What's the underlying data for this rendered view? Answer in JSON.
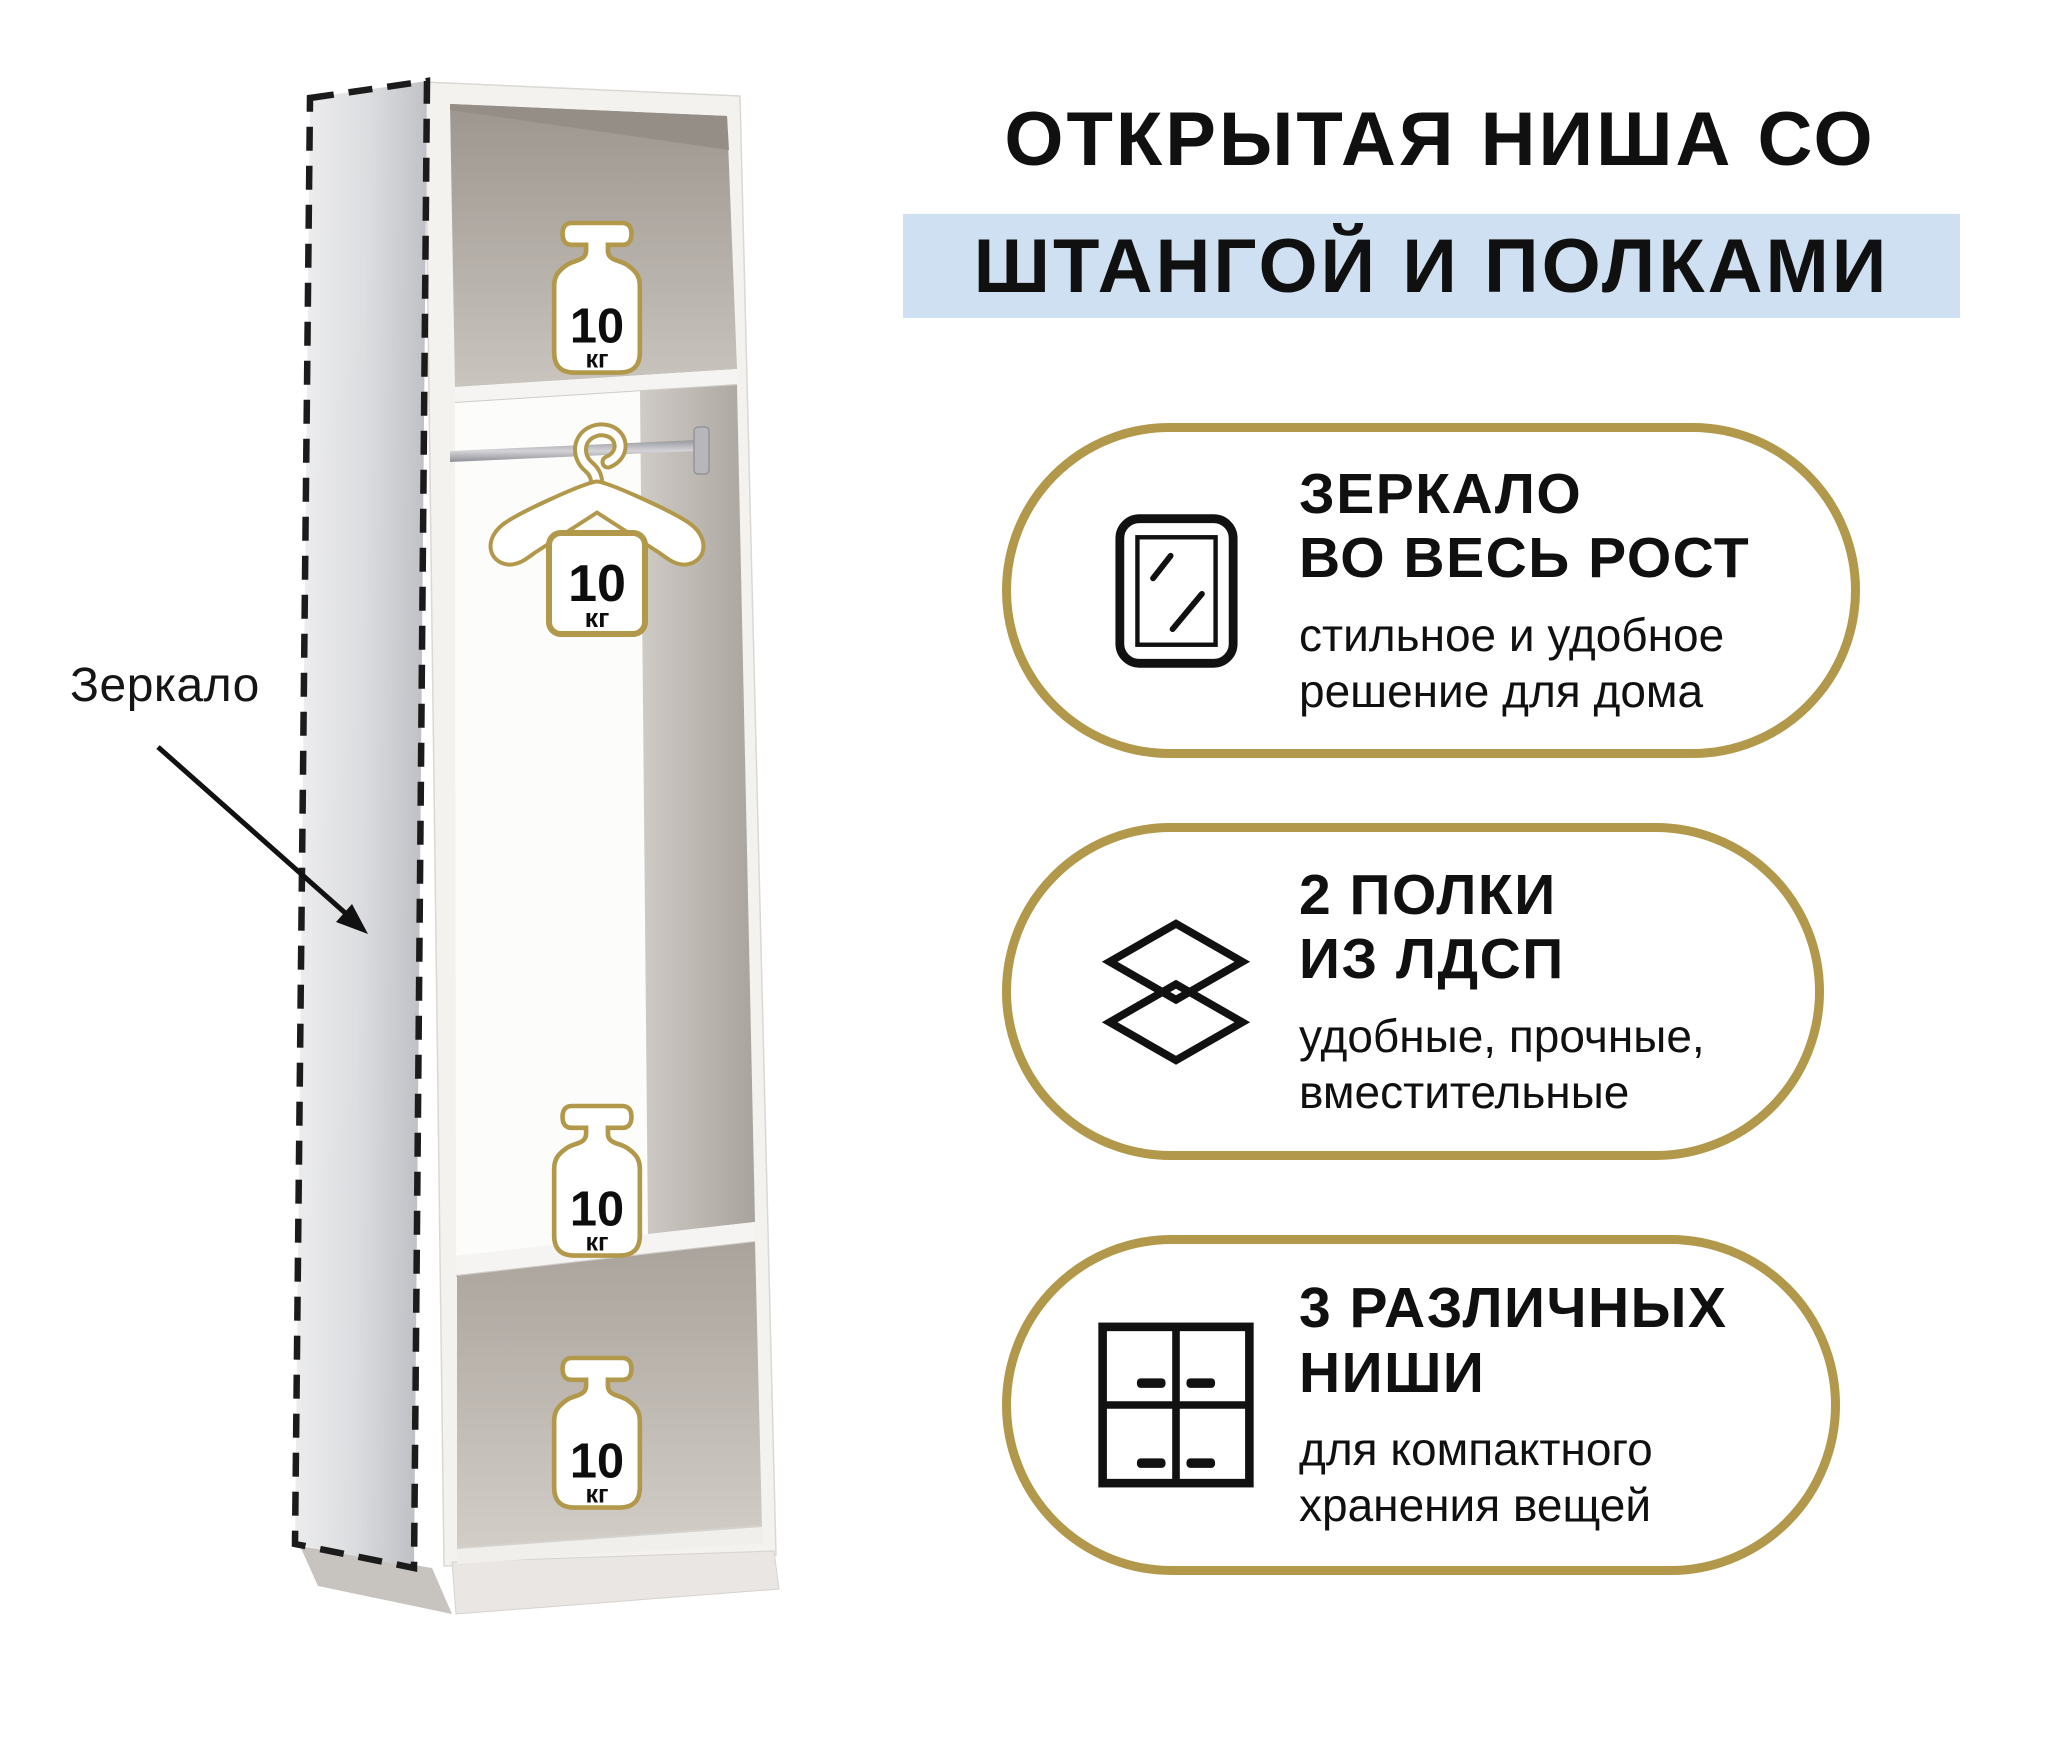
{
  "colors": {
    "accent_gold": "#b2984a",
    "highlight_blue": "#cfe0f3",
    "text": "#101010"
  },
  "title": {
    "line1": "ОТКРЫТАЯ НИША СО",
    "line2": "ШТАНГОЙ И ПОЛКАМИ"
  },
  "diagram": {
    "mirror_label": "Зеркало",
    "weights": [
      {
        "value": "10",
        "unit": "кг",
        "location": "top-niche"
      },
      {
        "value": "10",
        "unit": "кг",
        "location": "hanger-on-rod"
      },
      {
        "value": "10",
        "unit": "кг",
        "location": "middle-shelf"
      },
      {
        "value": "10",
        "unit": "кг",
        "location": "bottom-niche"
      }
    ]
  },
  "features": [
    {
      "icon": "mirror-icon",
      "title_lines": [
        "ЗЕРКАЛО",
        "ВО ВЕСЬ РОСТ"
      ],
      "desc_lines": [
        "стильное и удобное",
        "решение для дома"
      ]
    },
    {
      "icon": "layers-icon",
      "title_lines": [
        "2 ПОЛКИ",
        "ИЗ ЛДСП"
      ],
      "desc_lines": [
        "удобные, прочные,",
        "вместительные"
      ]
    },
    {
      "icon": "grid-niches-icon",
      "title_lines": [
        "3 РАЗЛИЧНЫХ",
        "НИШИ"
      ],
      "desc_lines": [
        "для компактного",
        "хранения вещей"
      ]
    }
  ]
}
